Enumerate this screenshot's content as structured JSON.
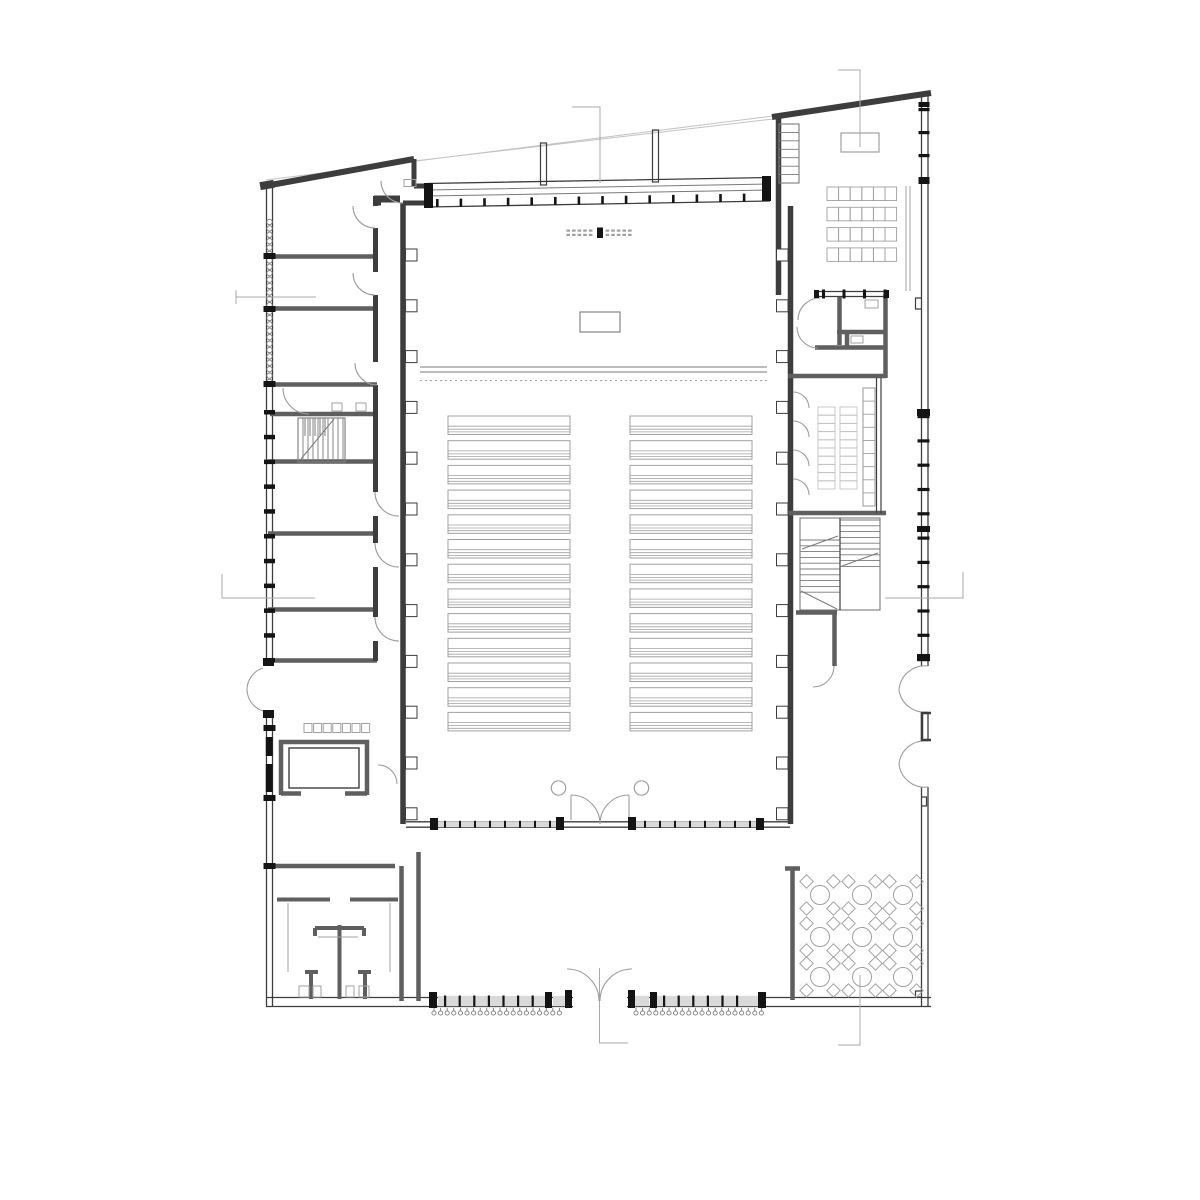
{
  "colors": {
    "bg": "#ffffff",
    "wall": "#3d3d3d",
    "midwall": "#5f5f5f",
    "mid": "#7a7a7a",
    "furn": "#a0a0a0",
    "faint": "#c2c2c2",
    "ink": "#141414",
    "band": "#d9d9d9",
    "arcgray": "#9c9c9c",
    "marker": "#a9a9a9"
  },
  "plan": {
    "auditorium": {
      "pew_blocks": 2,
      "pew_rows_per_block": 13,
      "columns": 2,
      "altar_tables": 1
    },
    "classroom": {
      "table_rows": 4,
      "table_cols": 6
    },
    "cafeteria": {
      "table_rows": 3,
      "table_cols": 3,
      "chairs_per_table": 4
    },
    "restrooms": {
      "toilets": 4,
      "stalls": 4
    },
    "cloakroom": {
      "coat_hooks": 7
    },
    "stairs": 2,
    "section_markers": 6
  },
  "generated": [
    {
      "name": "pew-block-left",
      "type": "pews",
      "x": 448,
      "y": 416,
      "w": 122,
      "rows": 13,
      "pitch": 24.7,
      "h": 18.5,
      "stroke": "furn"
    },
    {
      "name": "pew-block-right",
      "type": "pews",
      "x": 630,
      "y": 416,
      "w": 122,
      "rows": 13,
      "pitch": 24.7,
      "h": 18.5,
      "stroke": "furn"
    },
    {
      "name": "classroom-tables",
      "type": "grid-rects",
      "x": 827,
      "y": 187,
      "cols": 6,
      "rows": 4,
      "cw": 11.6,
      "ch": 13.5,
      "gx": 0,
      "gy": 6.8,
      "stroke": "furn"
    },
    {
      "name": "choir-shelf-stack-1",
      "type": "grid-rects",
      "x": 818,
      "y": 407,
      "cols": 1,
      "rows": 10,
      "cw": 17,
      "ch": 8.2,
      "gx": 0,
      "gy": 0,
      "stroke": "faint"
    },
    {
      "name": "choir-shelf-stack-2",
      "type": "grid-rects",
      "x": 840,
      "y": 407,
      "cols": 1,
      "rows": 10,
      "cw": 17,
      "ch": 8.2,
      "gx": 0,
      "gy": 0,
      "stroke": "faint"
    },
    {
      "name": "cafe-tables",
      "type": "cafe",
      "cx": [
        820,
        862,
        903
      ],
      "cy": [
        895,
        937,
        977
      ],
      "r": 9.5,
      "chair": 9.5,
      "off": 13.5,
      "stroke": "furn"
    },
    {
      "name": "west-wall-pilasters",
      "type": "vstack-rects",
      "x": 405.5,
      "y": 249,
      "n": 12,
      "pitch": 50.8,
      "w": 11.5,
      "h": 12,
      "fill": "bg",
      "stroke": "wall"
    },
    {
      "name": "east-wall-pilasters",
      "type": "vstack-rects",
      "x": 776.5,
      "y": 249,
      "n": 12,
      "pitch": 50.8,
      "w": 11.5,
      "h": 12,
      "fill": "bg",
      "stroke": "wall"
    },
    {
      "name": "left-wall-scallops",
      "type": "vcircles",
      "x": 269.5,
      "y": 222,
      "n": 26,
      "pitch": 6.4,
      "r": 2.7,
      "fill": "bg",
      "stroke": "mid"
    },
    {
      "name": "left-wall-sill-ticks",
      "type": "vstack-rects",
      "x": 264,
      "y": 410,
      "n": 11,
      "pitch": 24.8,
      "w": 11,
      "h": 4.5,
      "fill": "ink"
    },
    {
      "name": "left-wall-division-ticks",
      "type": "rect-list",
      "fill": "ink",
      "rects": [
        [
          263.5,
          253,
          12,
          6
        ],
        [
          263.5,
          306,
          12,
          6
        ],
        [
          263.5,
          381,
          12,
          6
        ],
        [
          263.5,
          725,
          12,
          6
        ],
        [
          263.5,
          795,
          12,
          6
        ],
        [
          263.5,
          863,
          12,
          6
        ]
      ]
    },
    {
      "name": "right-wall-band-ticks",
      "type": "vstack-rects",
      "x": 917.5,
      "y": 415,
      "n": 11,
      "pitch": 24.3,
      "w": 12,
      "h": 3.2,
      "fill": "ink"
    },
    {
      "name": "right-wall-top-ticks",
      "type": "vstack-rects",
      "x": 918.5,
      "y": 108,
      "n": 4,
      "pitch": 23,
      "w": 11,
      "h": 3.2,
      "fill": "ink"
    },
    {
      "name": "hall-top-band-ticks",
      "type": "hticks-sloped",
      "x": 436,
      "y": 199,
      "n": 14,
      "pitch": 23.6,
      "slope": -0.0175,
      "w": 2.6,
      "h": 8,
      "fill": "ink"
    },
    {
      "name": "hall-south-ticks-left",
      "type": "hstack-rects",
      "x": 444,
      "y": 820.8,
      "n": 8,
      "pitch": 15,
      "w": 2,
      "h": 7,
      "fill": "ink"
    },
    {
      "name": "hall-south-ticks-right",
      "type": "hstack-rects",
      "x": 644,
      "y": 820.8,
      "n": 8,
      "pitch": 15,
      "w": 2,
      "h": 7,
      "fill": "ink"
    },
    {
      "name": "bottom-wall-ticks-left",
      "type": "hstack-rects",
      "x": 444,
      "y": 995.5,
      "n": 7,
      "pitch": 14.6,
      "w": 2.2,
      "h": 11,
      "fill": "ink"
    },
    {
      "name": "bottom-wall-ticks-right",
      "type": "hstack-rects",
      "x": 663,
      "y": 995.5,
      "n": 6,
      "pitch": 14.6,
      "w": 2.2,
      "h": 11,
      "fill": "ink"
    },
    {
      "name": "radiators-left",
      "type": "radiators",
      "x": 434,
      "y": 1013,
      "n": 20,
      "pitch": 6.6,
      "r": 2.1,
      "stroke": "mid"
    },
    {
      "name": "radiators-right",
      "type": "radiators",
      "x": 636,
      "y": 1013,
      "n": 20,
      "pitch": 6.6,
      "r": 2.1,
      "stroke": "mid"
    },
    {
      "name": "coat-hooks",
      "type": "hstack-rects",
      "x": 304,
      "y": 723.5,
      "n": 7,
      "pitch": 9.6,
      "w": 8,
      "h": 9,
      "fill": "bg",
      "stroke": "furn"
    },
    {
      "name": "chancel-dash-rows",
      "type": "dashrows",
      "cx": 600,
      "y": 229.5,
      "rowGap": 4.3,
      "n": 12,
      "pitch": 5.6,
      "w": 3.6,
      "h": 2.2,
      "fill": "furn"
    },
    {
      "name": "wc-sinks",
      "type": "rect-list",
      "stroke": "furn",
      "rects": [
        [
          865,
          300,
          13,
          8
        ],
        [
          851,
          336,
          12,
          7
        ],
        [
          404,
          179.5,
          12,
          7
        ],
        [
          332,
          403,
          10,
          8
        ],
        [
          356,
          403,
          10,
          8
        ]
      ]
    },
    {
      "name": "toilet-fixtures",
      "type": "rect-list",
      "stroke": "furn",
      "rects": [
        [
          299,
          986,
          10,
          11
        ],
        [
          313,
          986,
          8,
          11
        ],
        [
          346,
          986,
          8,
          11
        ],
        [
          359,
          986,
          10,
          11
        ]
      ]
    },
    {
      "name": "choir-wall-shelf",
      "type": "vlines-rect",
      "x": 863,
      "y": 388,
      "w": 12,
      "h": 118,
      "n": 8,
      "stroke": "furn"
    },
    {
      "name": "classroom-shelf-ladder",
      "type": "vlines-rect",
      "x": 779,
      "y": 124,
      "w": 20,
      "h": 59,
      "n": 6,
      "stroke": "mid"
    },
    {
      "name": "stair-right-treads-lower",
      "type": "hlines",
      "x": 800.5,
      "y": 540,
      "w": 39,
      "n": 10,
      "pitch": 5.8,
      "stroke": "mid"
    },
    {
      "name": "stair-right-treads-upper",
      "type": "hlines",
      "x": 840.5,
      "y": 520,
      "w": 39,
      "n": 9,
      "pitch": 5.8,
      "stroke": "mid"
    },
    {
      "name": "stair-left-treads",
      "type": "vlines",
      "x": 303,
      "y": 418,
      "h": 44,
      "n": 9,
      "pitch": 5,
      "stroke": "mid"
    },
    {
      "name": "cloak-window-bands",
      "type": "rect-list",
      "fill": "ink",
      "rects": [
        [
          265.8,
          737,
          6.8,
          19
        ],
        [
          265.8,
          764,
          6.8,
          28
        ]
      ]
    },
    {
      "name": "bottom-wall-piers",
      "type": "rect-list",
      "fill": "ink",
      "rects": [
        [
          429,
          992,
          8,
          16
        ],
        [
          545,
          992,
          7,
          16
        ],
        [
          565,
          990,
          7,
          18
        ],
        [
          628,
          990,
          7,
          18
        ],
        [
          650,
          992,
          7,
          16
        ],
        [
          758,
          992,
          8,
          16
        ]
      ]
    },
    {
      "name": "hall-south-piers",
      "type": "rect-list",
      "fill": "ink",
      "rects": [
        [
          430,
          818,
          8,
          12
        ],
        [
          556,
          817,
          8,
          13
        ],
        [
          628,
          817,
          8,
          13
        ],
        [
          756,
          818,
          8,
          12
        ]
      ]
    },
    {
      "name": "hall-top-band-piers",
      "type": "rect-list",
      "fill": "ink",
      "rects": [
        [
          424,
          183,
          9,
          25
        ],
        [
          762,
          176,
          9,
          25
        ]
      ]
    },
    {
      "name": "right-wall-blocks",
      "type": "rect-list",
      "fill": "ink",
      "rects": [
        [
          917,
          409,
          13,
          7
        ],
        [
          917,
          654,
          13,
          7
        ],
        [
          917,
          526,
          13,
          6
        ],
        [
          918.5,
          102,
          11,
          5
        ],
        [
          918.5,
          179,
          11,
          5
        ]
      ]
    },
    {
      "name": "wc-band-ticks",
      "type": "hstack-rects",
      "x": 822,
      "y": 289.5,
      "n": 4,
      "pitch": 20.5,
      "w": 3,
      "h": 9,
      "fill": "ink"
    },
    {
      "name": "wc-band-blocks",
      "type": "rect-list",
      "fill": "ink",
      "rects": [
        [
          814,
          290,
          5,
          8
        ],
        [
          884,
          290,
          5,
          8
        ]
      ]
    },
    {
      "name": "left-door-jambs",
      "type": "rect-list",
      "fill": "ink",
      "rects": [
        [
          263,
          658,
          11,
          8
        ],
        [
          263,
          710,
          11,
          8
        ]
      ]
    }
  ]
}
